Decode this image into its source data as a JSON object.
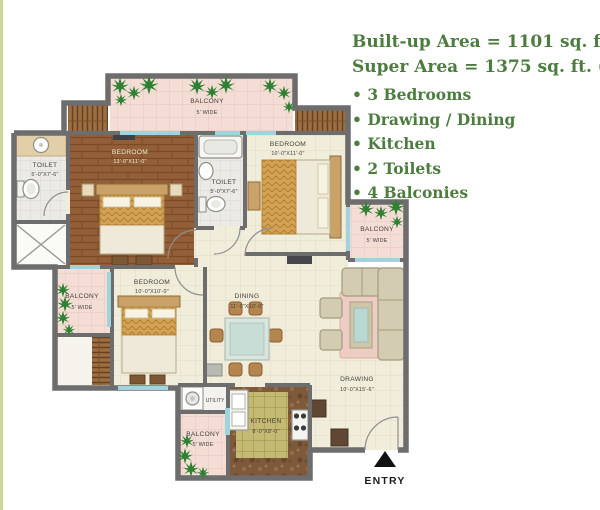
{
  "info_panel": {
    "line1": "Built-up Area = 1101 sq. ft.",
    "line2": "Super Area = 1375 sq. ft. ( Type-A )",
    "features": [
      "3 Bedrooms",
      "Drawing / Dining",
      "Kitchen",
      "2 Toilets",
      "4 Balconies"
    ]
  },
  "plan": {
    "balcony_top": {
      "label": "BALCONY",
      "size": "5' WIDE"
    },
    "balcony_right": {
      "label": "BALCONY",
      "size": "5' WIDE"
    },
    "balcony_left": {
      "label": "BALCONY",
      "size": "5' WIDE"
    },
    "balcony_bottom": {
      "label": "BALCONY",
      "size": "5' WIDE"
    },
    "toilet_master": {
      "label": "TOILET",
      "size": "5'-0\"X7'-6\""
    },
    "toilet_common": {
      "label": "TOILET",
      "size": "5'-0\"X7'-6\""
    },
    "bedroom_master": {
      "label": "BEDROOM",
      "size": "13'-0\"X11'-0\""
    },
    "bedroom_top_right": {
      "label": "BEDROOM",
      "size": "10'-0\"X11'-0\""
    },
    "bedroom_bottom": {
      "label": "BEDROOM",
      "size": "10'-0\"X10'-0\""
    },
    "dining": {
      "label": "DINING",
      "size": "11'-0\"X10'-0\""
    },
    "drawing": {
      "label": "DRAWING",
      "size": "10'-0\"X15'-6\""
    },
    "kitchen": {
      "label": "KITCHEN",
      "size": "8'-0\"X8'-0\""
    },
    "utility": {
      "label": "UTILITY"
    },
    "entry": {
      "label": "ENTRY"
    }
  },
  "colors": {
    "heading_green": "#4d7c3f",
    "wall_gray": "#6d6d6d",
    "balcony_pink": "#f4ddd4",
    "wood_brown": "#925f38",
    "plant_green": "#2e8033",
    "window_blue": "#9fd4dd"
  }
}
